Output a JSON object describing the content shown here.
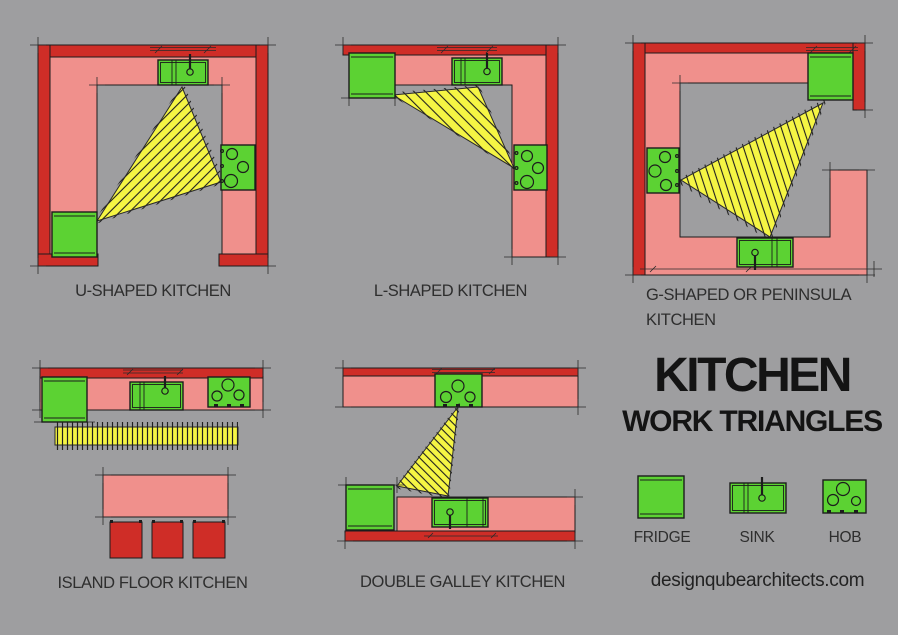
{
  "title": {
    "line1": "KITCHEN",
    "line2": "WORK TRIANGLES"
  },
  "website": "designqubearchitects.com",
  "diagrams": {
    "u_shaped": {
      "label": "U-SHAPED KITCHEN"
    },
    "l_shaped": {
      "label": "L-SHAPED KITCHEN"
    },
    "g_shaped": {
      "label": "G-SHAPED OR PENINSULA KITCHEN"
    },
    "island": {
      "label": "ISLAND FLOOR KITCHEN"
    },
    "double_galley": {
      "label": "DOUBLE GALLEY KITCHEN"
    }
  },
  "legend": {
    "fridge": {
      "label": "FRIDGE",
      "icon": "fridge-icon"
    },
    "sink": {
      "label": "SINK",
      "icon": "sink-icon"
    },
    "hob": {
      "label": "HOB",
      "icon": "hob-icon"
    }
  },
  "colors": {
    "bg": "#9e9ea0",
    "wall": "#cf2d27",
    "counter": "#f0908c",
    "appliance": "#5cd233",
    "triangle": "#f5f544",
    "ink": "#1c1c1c",
    "text": "#2e2e2e",
    "title": "#141414"
  }
}
